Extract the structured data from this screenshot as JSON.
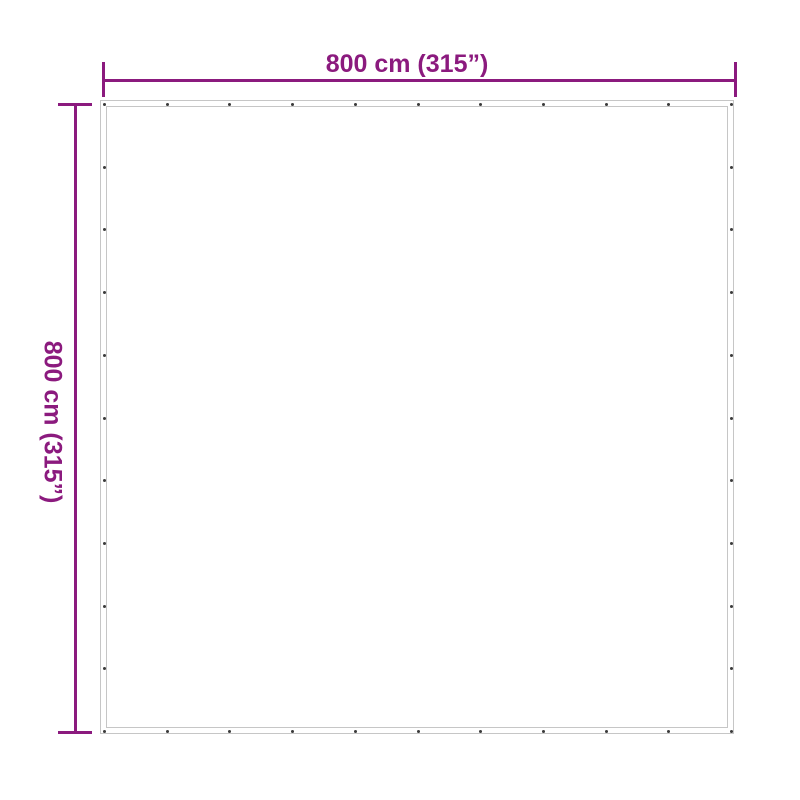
{
  "diagram": {
    "type": "product-dimension-diagram",
    "accent_color": "#8B1A7E",
    "width_dimension": {
      "label": "800 cm (315”)",
      "value_cm": 800,
      "value_inches": 315
    },
    "height_dimension": {
      "label": "800 cm (315”)",
      "value_cm": 800,
      "value_inches": 315
    },
    "tarp": {
      "shape": "square",
      "border_color": "#c6c6c6",
      "eyelet_color": "#3b3b3b",
      "eyelets_per_edge": 11
    }
  }
}
